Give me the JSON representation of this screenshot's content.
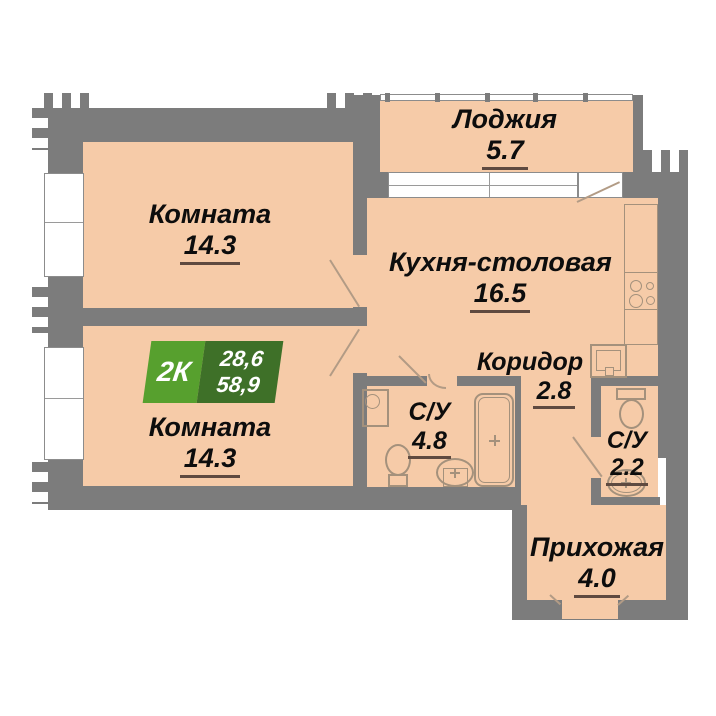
{
  "plan": {
    "badge": {
      "type": "2К",
      "area_upper": "28,6",
      "area_lower": "58,9"
    },
    "rooms": {
      "room_top": {
        "name": "Комната",
        "area": "14.3"
      },
      "room_bottom": {
        "name": "Комната",
        "area": "14.3"
      },
      "loggia": {
        "name": "Лоджия",
        "area": "5.7"
      },
      "kitchen": {
        "name": "Кухня-столовая",
        "area": "16.5"
      },
      "corridor": {
        "name": "Коридор",
        "area": "2.8"
      },
      "bath_main": {
        "name": "С/У",
        "area": "4.8"
      },
      "bath_small": {
        "name": "С/У",
        "area": "2.2"
      },
      "hall": {
        "name": "Прихожая",
        "area": "4.0"
      }
    },
    "colors": {
      "wall": "#7c7c7c",
      "floor": "#f6cba8",
      "badge_green": "#57a02e",
      "badge_dark_green": "#3e7028",
      "underline": "#5f4a40",
      "fixture_line": "#a4917c"
    }
  }
}
